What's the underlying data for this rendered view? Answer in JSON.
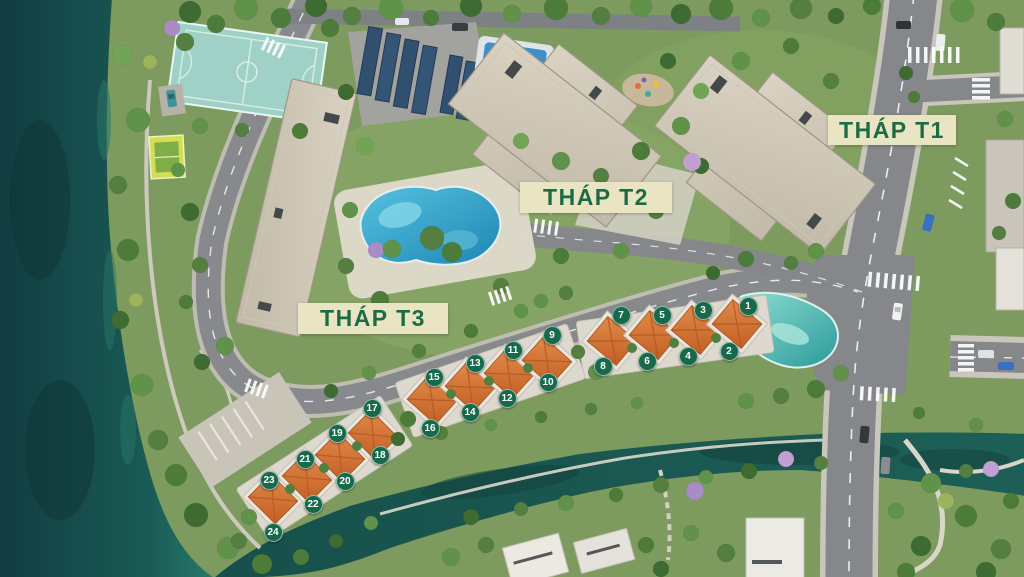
{
  "scene": {
    "type": "aerial-masterplan-render",
    "colors": {
      "label_bg": "#e9e4c2",
      "label_text": "#1d6b45",
      "marker_bg": "#17694a",
      "marker_text": "#ffffff",
      "lake_water": "#1a5b55",
      "road": "#85878a",
      "villa_roof": "#cf6a2e",
      "tower_roof": "#d3cbba",
      "pool": "#2e9cc3",
      "lagoon_pool": "#3faea6",
      "basketball_court": "#a5d8cc"
    },
    "labels": [
      {
        "id": "t1",
        "text": "THÁP T1",
        "x": 828,
        "y": 115,
        "w": 128,
        "h": 30
      },
      {
        "id": "t2",
        "text": "THÁP T2",
        "x": 520,
        "y": 182,
        "w": 152,
        "h": 31
      },
      {
        "id": "t3",
        "text": "THÁP T3",
        "x": 298,
        "y": 303,
        "w": 150,
        "h": 31
      }
    ],
    "markers": [
      {
        "n": "1",
        "x": 748,
        "y": 306
      },
      {
        "n": "2",
        "x": 729,
        "y": 351
      },
      {
        "n": "3",
        "x": 703,
        "y": 310
      },
      {
        "n": "4",
        "x": 688,
        "y": 356
      },
      {
        "n": "5",
        "x": 662,
        "y": 315
      },
      {
        "n": "6",
        "x": 647,
        "y": 361
      },
      {
        "n": "7",
        "x": 621,
        "y": 315
      },
      {
        "n": "8",
        "x": 603,
        "y": 366
      },
      {
        "n": "9",
        "x": 552,
        "y": 335
      },
      {
        "n": "10",
        "x": 548,
        "y": 382
      },
      {
        "n": "11",
        "x": 513,
        "y": 350
      },
      {
        "n": "12",
        "x": 507,
        "y": 398
      },
      {
        "n": "13",
        "x": 475,
        "y": 363
      },
      {
        "n": "14",
        "x": 470,
        "y": 412
      },
      {
        "n": "15",
        "x": 434,
        "y": 377
      },
      {
        "n": "16",
        "x": 430,
        "y": 428
      },
      {
        "n": "17",
        "x": 372,
        "y": 408
      },
      {
        "n": "18",
        "x": 380,
        "y": 455
      },
      {
        "n": "19",
        "x": 337,
        "y": 433
      },
      {
        "n": "20",
        "x": 345,
        "y": 481
      },
      {
        "n": "21",
        "x": 305,
        "y": 459
      },
      {
        "n": "22",
        "x": 313,
        "y": 504
      },
      {
        "n": "23",
        "x": 269,
        "y": 480
      },
      {
        "n": "24",
        "x": 273,
        "y": 532
      }
    ]
  }
}
